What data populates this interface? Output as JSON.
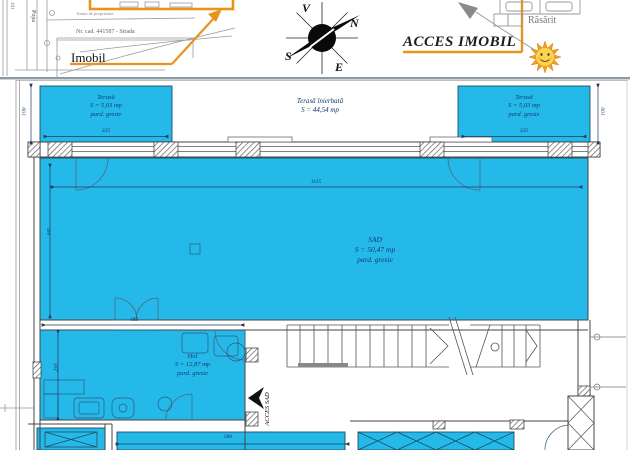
{
  "header": {
    "site_plan": {
      "imobil_label": "Imobil",
      "cad_label": "Nr. cad. 441587 - Strada",
      "boundary_note": "limita de proprietate",
      "street_name": "Popa",
      "street_no": "101"
    },
    "compass": {
      "v": "V",
      "n": "N",
      "s": "S",
      "e": "E"
    },
    "access_imobil_label": "ACCES IMOBIL",
    "rasarit_label": "Răsărit"
  },
  "plan": {
    "rooms": [
      {
        "name": "Terasă",
        "area": "S = 5,03 mp",
        "floor": "pard. gresie"
      },
      {
        "name": "Terasă înierbată",
        "area": "S = 44,54 mp"
      },
      {
        "name": "Terasă",
        "area": "S = 5,03 mp",
        "floor": "pard. gresie"
      },
      {
        "name": "SAD",
        "area": "S = 50,47 mp",
        "floor": "pard. gresie"
      },
      {
        "name": "Hol",
        "area": "S = 12,87 mp",
        "floor": "pard. gresie"
      }
    ],
    "access_sad_label": "ACCES SAD",
    "dimensions": {
      "terrace_height": "100",
      "terrace_width": "335",
      "sad_width": "1115",
      "sad_height": "445",
      "hol_width": "485",
      "hol_height": "233",
      "parapet_width": "580"
    }
  },
  "colors": {
    "room_fill": "#25b9ea",
    "accent_orange": "#e8941c",
    "label_navy": "#0d3c6e"
  }
}
